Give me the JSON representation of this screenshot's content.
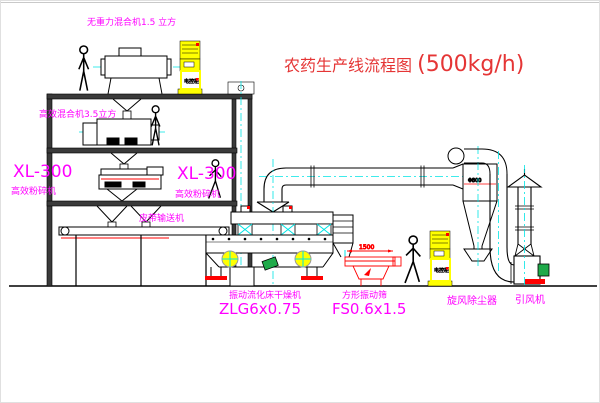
{
  "title": {
    "name": "农药生产线流程图",
    "capacity": "(500kg/h)"
  },
  "labels": {
    "gravity_mixer": "无重力混合机1.5 立方",
    "high_eff_mixer": "高效混合机3.5立方",
    "mill_left_model": "XL-300",
    "mill_left_name": "高效粉碎机",
    "mill_mid_model": "XL-300",
    "mill_mid_name": "高效粉碎机",
    "belt_conveyor": "皮带输送机",
    "dryer_name": "振动流化床干燥机",
    "dryer_model": "ZLG6x0.75",
    "screen_name": "方形振动筛",
    "screen_model": "FS0.6x1.5",
    "cyclone_name": "旋风除尘器",
    "fan_name": "引风机",
    "cabinet_top": "电控柜",
    "cabinet_right": "电控柜"
  },
  "dimensions": {
    "screen_length": "1500",
    "cyclone_diameter": "Φ800"
  },
  "colors": {
    "label_magenta": "#ff00ff",
    "title_red": "#e53535",
    "centerline_cyan": "#00e5e5",
    "accent_red": "#ff0000",
    "cabinet_yellow": "#ffff00",
    "motor_green": "#1faa4a",
    "line_black": "#000000"
  }
}
